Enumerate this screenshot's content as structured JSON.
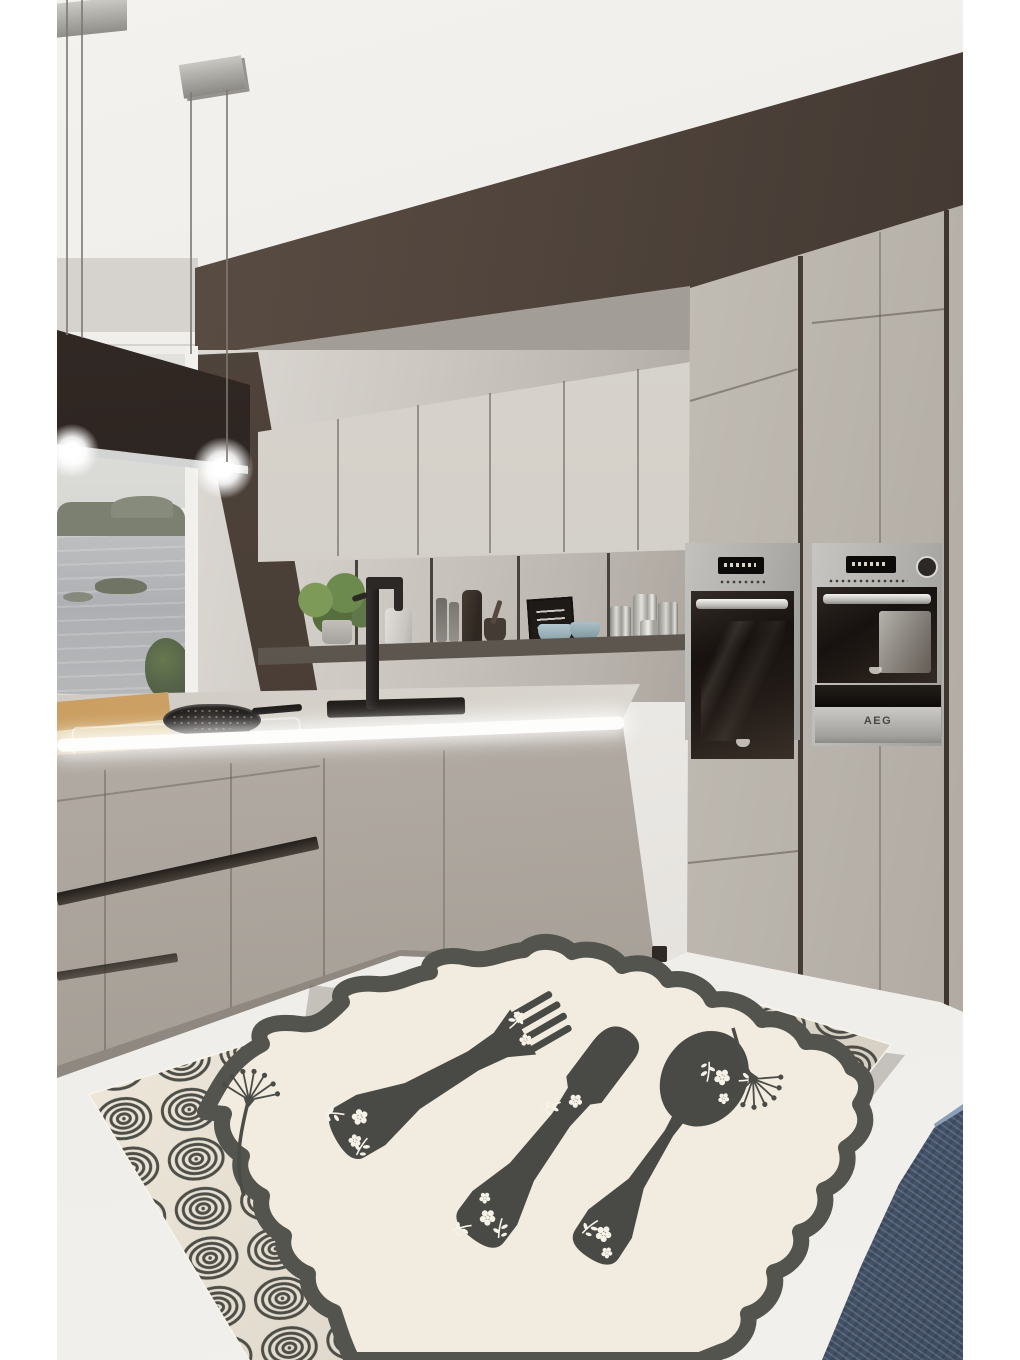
{
  "scene": {
    "type": "product-photo",
    "setting": "modern gray kitchen interior with island, range hood, wall ovens and lake-view window",
    "subject": "decorative kitchen area rug shown in perspective on the floor"
  },
  "ovens": {
    "brand_label": "AEG"
  },
  "rug": {
    "border_pattern": "charcoal concentric circles on cream",
    "center": "cream field inside wavy scalloped charcoal frame",
    "motifs": [
      "fork silhouette",
      "knife silhouette",
      "spoon silhouette",
      "white flower sprigs",
      "dandelion flourishes"
    ]
  },
  "palette": {
    "ceiling": "#efedea",
    "soffit_brown": "#4f4339",
    "wall_gray": "#a7a19c",
    "upper_cabinets": "#d5d1ca",
    "tall_cabinets": "#c6c1ba",
    "range_hood": "#2b2320",
    "countertop": "#d6d1ca",
    "base_cabinets": "#b4ada5",
    "floor": "#e9e7e3",
    "rug_cream": "#f1eadd",
    "rug_charcoal": "#4e4f49",
    "fabric_blue": "#566880",
    "wood_board": "#cda267",
    "window_water": "#aeb0b2",
    "window_trees": "#7b7f70",
    "bowl_blue": "#a9c0c6"
  }
}
